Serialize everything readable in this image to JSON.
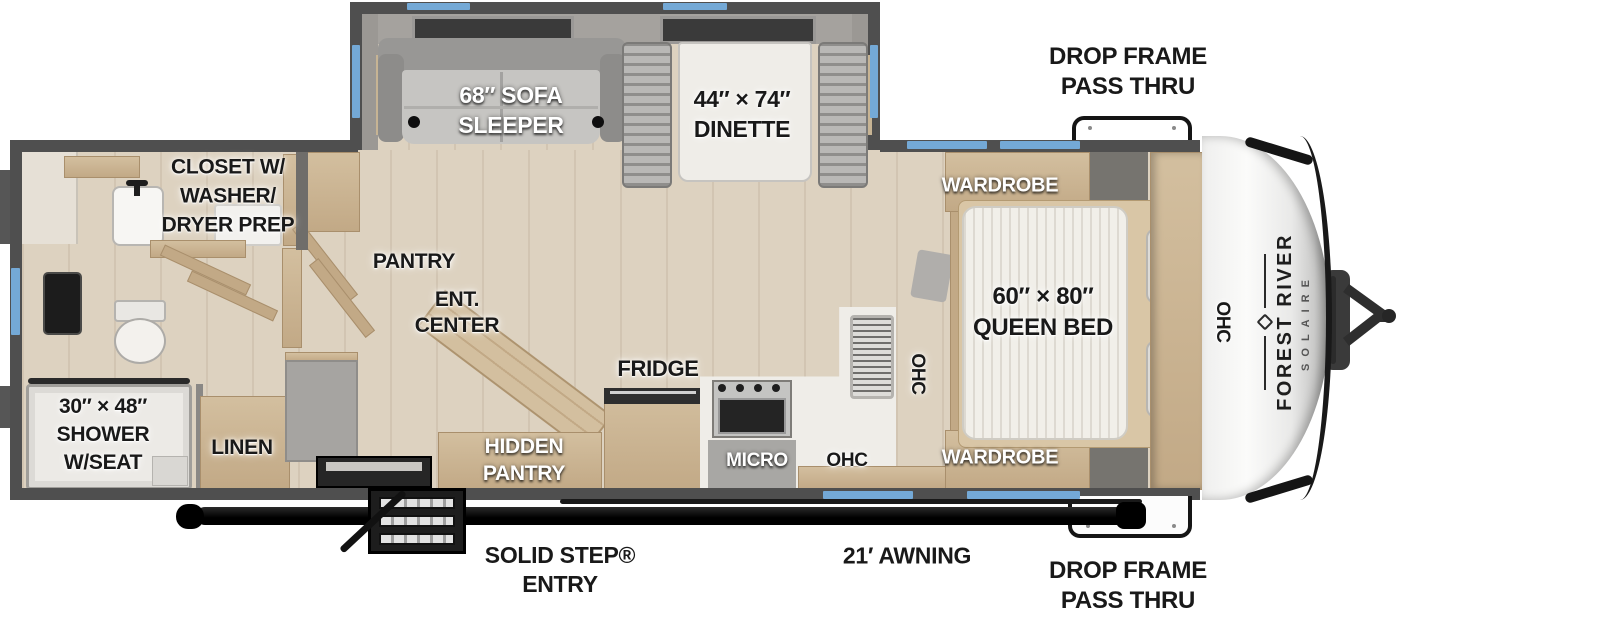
{
  "branding": {
    "make": "FOREST RIVER",
    "model": "SOLAIRE"
  },
  "labels": {
    "closet": "CLOSET W/\nWASHER/\nDRYER PREP",
    "sofa": "68″ SOFA\nSLEEPER",
    "dinette": "44″ × 74″\nDINETTE",
    "drop_frame_top": "DROP FRAME\nPASS THRU",
    "drop_frame_bottom": "DROP FRAME\nPASS THRU",
    "wardrobe_top": "WARDROBE",
    "wardrobe_bottom": "WARDROBE",
    "queen_bed": "60″ × 80″\nQUEEN BED",
    "ohc_side": "OHC",
    "ohc_front": "OHC",
    "ohc_kitchen": "OHC",
    "micro": "MICRO",
    "fridge": "FRIDGE",
    "hidden_pantry": "HIDDEN\nPANTRY",
    "pantry": "PANTRY",
    "ent_center": "ENT.\nCENTER",
    "linen": "LINEN",
    "shower": "30″ × 48″\nSHOWER\nW/SEAT",
    "solid_step": "SOLID STEP®\nENTRY",
    "awning": "21′ AWNING"
  },
  "colors": {
    "wall": "#4f4f4f",
    "floor": "#ddd2c0",
    "wood": "#d3bf9f",
    "wood_dark": "#c2a986",
    "accent_blue": "#74a9d6",
    "counter": "#efede8",
    "upholstery": "#b7b6b4",
    "mattress": "#f1efe9",
    "frame_black": "#111111",
    "cap_white": "#f5f5f4"
  }
}
